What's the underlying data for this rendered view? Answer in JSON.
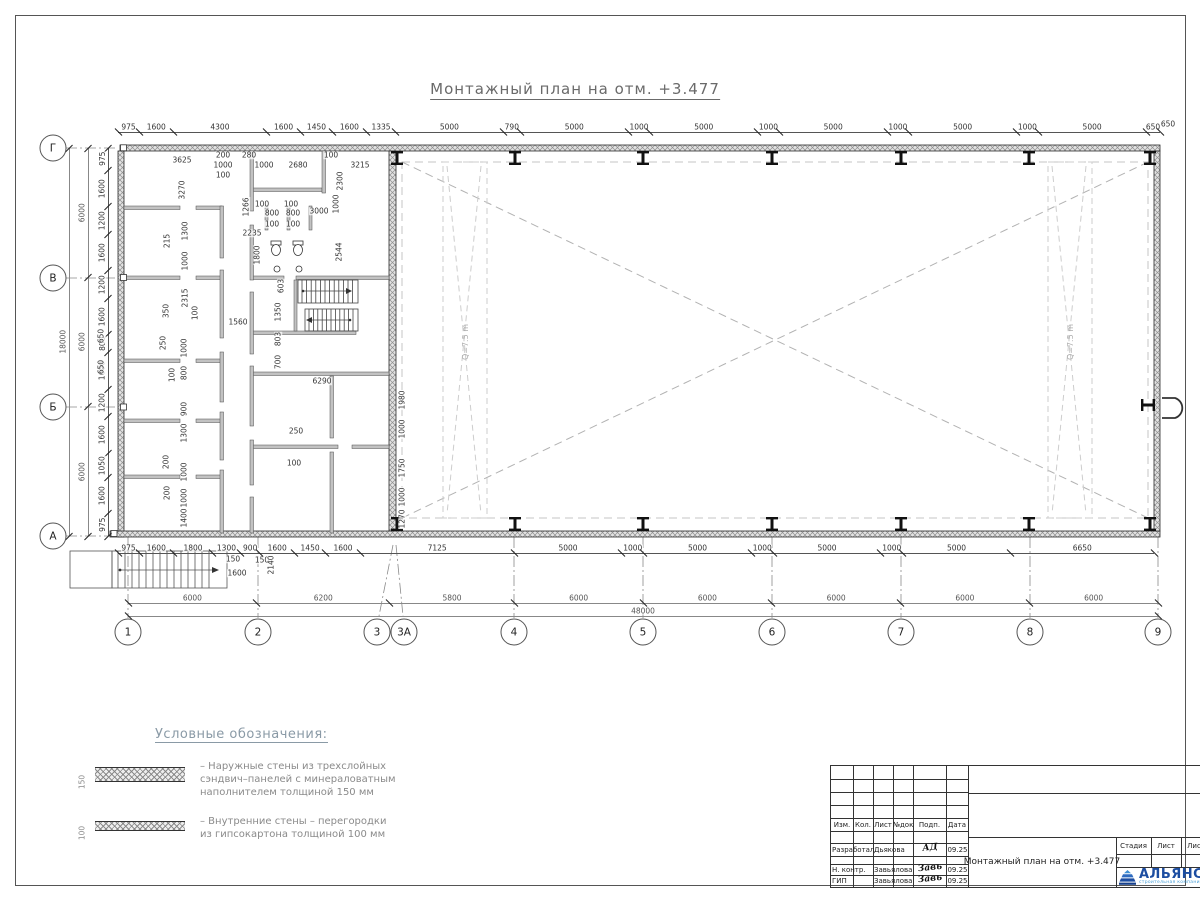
{
  "title": "Монтажный план на отм. +3.477",
  "axes": {
    "rows": [
      "Г",
      "В",
      "Б",
      "А"
    ],
    "cols": [
      "1",
      "2",
      "3",
      "3А",
      "4",
      "5",
      "6",
      "7",
      "8",
      "9"
    ]
  },
  "dim_chains": {
    "top_outer": [
      975,
      1600,
      4300,
      1600,
      1450,
      1600,
      1335,
      5000,
      790,
      5000,
      1000,
      5000,
      1000,
      5000,
      1000,
      5000,
      1000,
      5000,
      650
    ],
    "bottom_inner": [
      975,
      1600,
      1800,
      1300,
      900,
      1600,
      1450,
      1600,
      7125,
      5000,
      1000,
      5000,
      1000,
      5000,
      1000,
      5000,
      6650
    ],
    "bottom_axes": [
      6000,
      6200,
      5800,
      6000,
      6000,
      6000,
      6000,
      6000
    ],
    "bottom_total": [
      48000
    ],
    "left_spans": [
      6000,
      6000,
      6000
    ],
    "left_total": [
      18000
    ],
    "left_inner": [
      975,
      1600,
      1200,
      1600,
      1200,
      1600,
      800,
      1600,
      1200,
      1600,
      1050,
      1600,
      975
    ]
  },
  "interior_dims": [
    {
      "t": "3625",
      "x": 182,
      "y": 160
    },
    {
      "t": "200",
      "x": 223,
      "y": 155
    },
    {
      "t": "1000",
      "x": 223,
      "y": 165
    },
    {
      "t": "100",
      "x": 223,
      "y": 175
    },
    {
      "t": "280",
      "x": 249,
      "y": 155
    },
    {
      "t": "1000",
      "x": 264,
      "y": 165
    },
    {
      "t": "2680",
      "x": 298,
      "y": 165
    },
    {
      "t": "100",
      "x": 331,
      "y": 155
    },
    {
      "t": "3215",
      "x": 360,
      "y": 165
    },
    {
      "t": "2300",
      "x": 340,
      "y": 181,
      "r": 1
    },
    {
      "t": "3270",
      "x": 182,
      "y": 190,
      "r": 1
    },
    {
      "t": "1266",
      "x": 246,
      "y": 207,
      "r": 1
    },
    {
      "t": "2235",
      "x": 252,
      "y": 233
    },
    {
      "t": "100",
      "x": 262,
      "y": 204
    },
    {
      "t": "800",
      "x": 272,
      "y": 213
    },
    {
      "t": "100",
      "x": 272,
      "y": 224
    },
    {
      "t": "100",
      "x": 291,
      "y": 204
    },
    {
      "t": "800",
      "x": 293,
      "y": 213
    },
    {
      "t": "100",
      "x": 293,
      "y": 224
    },
    {
      "t": "3000",
      "x": 319,
      "y": 211
    },
    {
      "t": "1000",
      "x": 336,
      "y": 204,
      "r": 1
    },
    {
      "t": "1800",
      "x": 257,
      "y": 255,
      "r": 1
    },
    {
      "t": "2544",
      "x": 339,
      "y": 252,
      "r": 1
    },
    {
      "t": "1300",
      "x": 185,
      "y": 231,
      "r": 1
    },
    {
      "t": "215",
      "x": 167,
      "y": 241,
      "r": 1
    },
    {
      "t": "1000",
      "x": 185,
      "y": 261,
      "r": 1
    },
    {
      "t": "2315",
      "x": 185,
      "y": 298,
      "r": 1
    },
    {
      "t": "350",
      "x": 166,
      "y": 311,
      "r": 1
    },
    {
      "t": "100",
      "x": 195,
      "y": 313,
      "r": 1
    },
    {
      "t": "1560",
      "x": 238,
      "y": 322
    },
    {
      "t": "603",
      "x": 281,
      "y": 286,
      "r": 1
    },
    {
      "t": "1350",
      "x": 278,
      "y": 312,
      "r": 1
    },
    {
      "t": "803",
      "x": 278,
      "y": 339,
      "r": 1
    },
    {
      "t": "700",
      "x": 278,
      "y": 362,
      "r": 1
    },
    {
      "t": "6290",
      "x": 322,
      "y": 381
    },
    {
      "t": "250",
      "x": 163,
      "y": 343,
      "r": 1
    },
    {
      "t": "1000",
      "x": 184,
      "y": 348,
      "r": 1
    },
    {
      "t": "100",
      "x": 172,
      "y": 375,
      "r": 1
    },
    {
      "t": "800",
      "x": 184,
      "y": 373,
      "r": 1
    },
    {
      "t": "900",
      "x": 184,
      "y": 409,
      "r": 1
    },
    {
      "t": "1300",
      "x": 184,
      "y": 433,
      "r": 1
    },
    {
      "t": "200",
      "x": 166,
      "y": 462,
      "r": 1
    },
    {
      "t": "1000",
      "x": 184,
      "y": 472,
      "r": 1
    },
    {
      "t": "200",
      "x": 167,
      "y": 493,
      "r": 1
    },
    {
      "t": "1000",
      "x": 184,
      "y": 498,
      "r": 1
    },
    {
      "t": "1400",
      "x": 184,
      "y": 518,
      "r": 1
    },
    {
      "t": "250",
      "x": 296,
      "y": 431
    },
    {
      "t": "100",
      "x": 294,
      "y": 463
    },
    {
      "t": "1980",
      "x": 402,
      "y": 400,
      "r": 1
    },
    {
      "t": "1000",
      "x": 402,
      "y": 429,
      "r": 1
    },
    {
      "t": "1750",
      "x": 402,
      "y": 468,
      "r": 1
    },
    {
      "t": "1000",
      "x": 402,
      "y": 497,
      "r": 1
    },
    {
      "t": "1270",
      "x": 402,
      "y": 519,
      "r": 1
    },
    {
      "t": "650",
      "x": 101,
      "y": 336,
      "r": 1
    },
    {
      "t": "650",
      "x": 101,
      "y": 367,
      "r": 1
    },
    {
      "t": "150",
      "x": 233,
      "y": 559
    },
    {
      "t": "150",
      "x": 262,
      "y": 560
    },
    {
      "t": "2140",
      "x": 271,
      "y": 565,
      "r": 1
    },
    {
      "t": "1600",
      "x": 237,
      "y": 573
    },
    {
      "t": "650",
      "x": 1168,
      "y": 124
    }
  ],
  "crane_labels": [
    {
      "t": "Q=7.5 m",
      "x": 466,
      "y": 342
    },
    {
      "t": "Q=7.5 m",
      "x": 1071,
      "y": 342
    }
  ],
  "legend": {
    "title": "Условные обозначения:",
    "items": [
      {
        "dim": "150",
        "text": "– Наружные стены из трехслойных\nсэндвич–панелей с минераловатным\nнаполнителем толщиной 150 мм"
      },
      {
        "dim": "100",
        "text": "– Внутренние стены – перегородки\nиз гипсокартона толщиной 100 мм"
      }
    ]
  },
  "stamp": {
    "header_cols": [
      "Изм.",
      "Кол.",
      "Лист",
      "№док",
      "Подп.",
      "Дата"
    ],
    "rows": [
      {
        "role": "Разработал",
        "name": "Дьякова",
        "sig": "АД",
        "date": "09.25"
      },
      {
        "role": "Н. контр.",
        "name": "Завьялова",
        "sig": "Завь",
        "date": "09.25"
      },
      {
        "role": "ГИП",
        "name": "Завьялова",
        "sig": "Завь",
        "date": "09.25"
      }
    ],
    "doc_title": "Монтажный план на отм. +3.477",
    "right_header": [
      "Стадия",
      "Лист",
      "Лист"
    ],
    "logo_text": "АЛЬЯНС",
    "logo_sub": "строительная компания"
  }
}
